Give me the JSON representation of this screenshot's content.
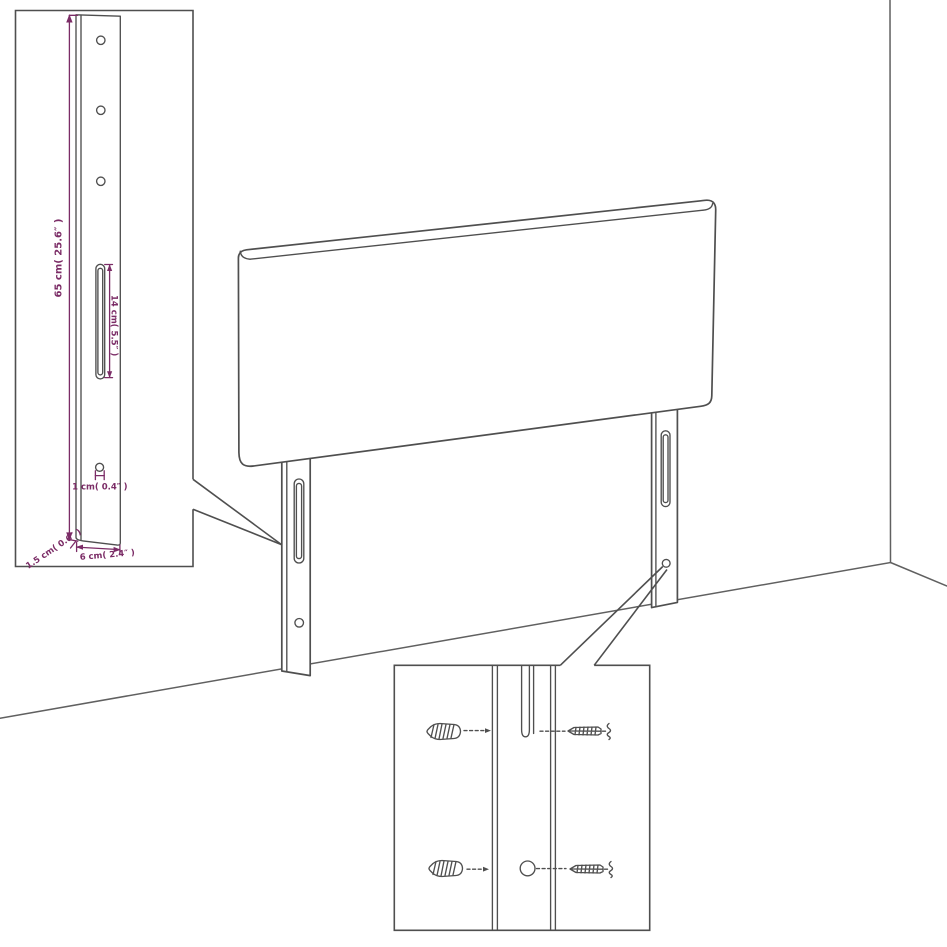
{
  "scene": {
    "title": "headboard-assembly-dimension-diagram",
    "subject": "upholstered headboard with two mounting legs shown against a wall corner",
    "insets": [
      "leg-dimension-detail",
      "mounting-hardware-detail"
    ]
  },
  "colors": {
    "line": "#4f4f4f",
    "wall_line": "#606060",
    "dimension": "#7b2c66",
    "background": "#ffffff"
  },
  "labels": {
    "leg_height": "65 cm( 25.6″ )",
    "slot_length": "14 cm( 5.5″ )",
    "hole_diameter": "1 cm( 0.4″ )",
    "leg_thickness": "1.5 cm( 0.6″ )",
    "leg_width": "6 cm( 2.4″ )"
  }
}
